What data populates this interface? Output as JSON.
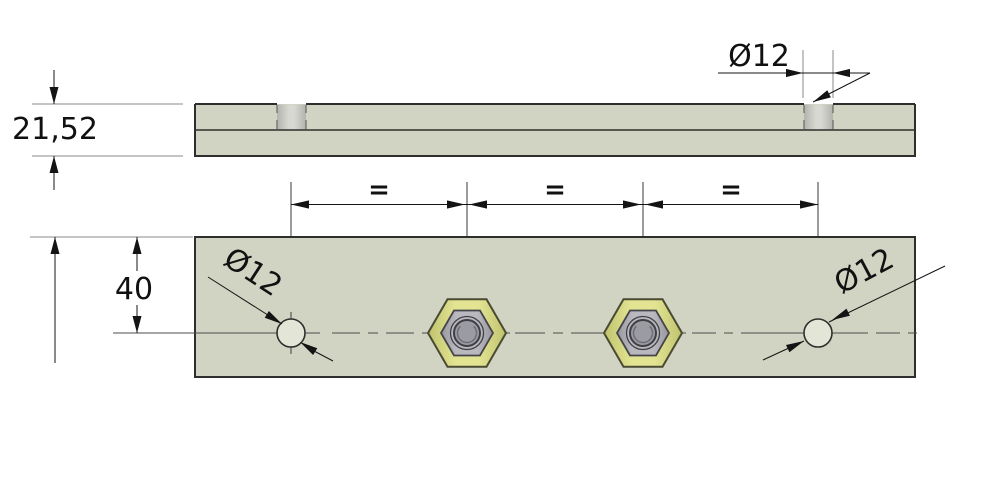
{
  "drawing": {
    "labels": {
      "thickness": "21,52",
      "top_hole_diameter": "Ø12",
      "spacing": [
        "=",
        "=",
        "="
      ],
      "hole_offset": "40",
      "left_hole_diameter": "Ø12",
      "right_hole_diameter": "Ø12"
    },
    "colors": {
      "background": "#ffffff",
      "plate_fill": "#d1d4c2",
      "outline": "#2e2e2c",
      "dim": "#141414",
      "ext": "#8a8a8a",
      "center": "#4c4c4c",
      "text": "#111111",
      "hole_fill": "#e3e5d6",
      "bore_edge": "#b2b3ac",
      "bore_mid": "#d7d8d1",
      "hex_outer_fill": "#e2e492",
      "hex_outer_edge": "#bfc26d",
      "hex_outline": "#4a4a32",
      "hex_inner_fill": "#b8b8be",
      "hex_inner_edge": "#97979d",
      "hex_inner_outline": "#45454b",
      "bolt_outer_fill": "#b6b6bc",
      "bolt_inner_fill": "#9b9ba2",
      "bolt_outline": "#3f3f45",
      "bolt_arc": "#6e6e76"
    }
  }
}
